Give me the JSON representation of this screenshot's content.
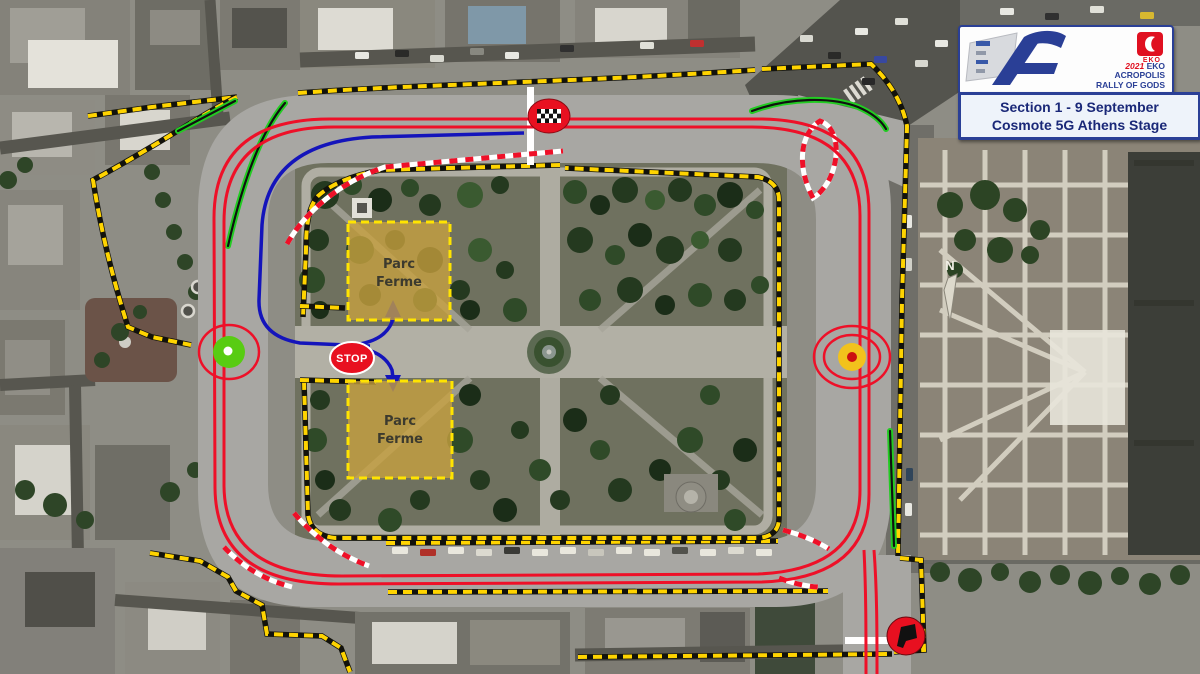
{
  "map": {
    "compass_label": "N",
    "stop_label": "STOP",
    "parc_ferme": {
      "line1": "Parc",
      "line2": "Ferme"
    },
    "stage_markers": {
      "finish": "checkered-flag-in-red-circle",
      "start": "black-flag-in-red-circle",
      "control_left": "green-dot-control",
      "control_right": "yellow-dot-control",
      "stop": "stop-sign"
    }
  },
  "logo_panel": {
    "year": "2021",
    "brand": "EKO",
    "title_line1": "ACROPOLIS",
    "title_line2": "RALLY OF GODS",
    "eko_badge_label": "EKO",
    "section_line1": "Section 1  -  9 September",
    "section_line2": "Cosmote 5G Athens Stage"
  },
  "colors": {
    "route_red": "#ee1028",
    "route_blue": "#1414bb",
    "barrier_green": "#22cc22",
    "boundary_yellow": "#ffd400",
    "track_gray": "#a8a7a3",
    "parc_ferme_fill": "#c9a23f",
    "parc_ferme_border": "#ffe400",
    "control_green": "#58cc12",
    "control_yellow": "#f2c21c",
    "marker_red": "#e81020",
    "eko_red": "#e01020",
    "panel_navy": "#1a2878"
  }
}
